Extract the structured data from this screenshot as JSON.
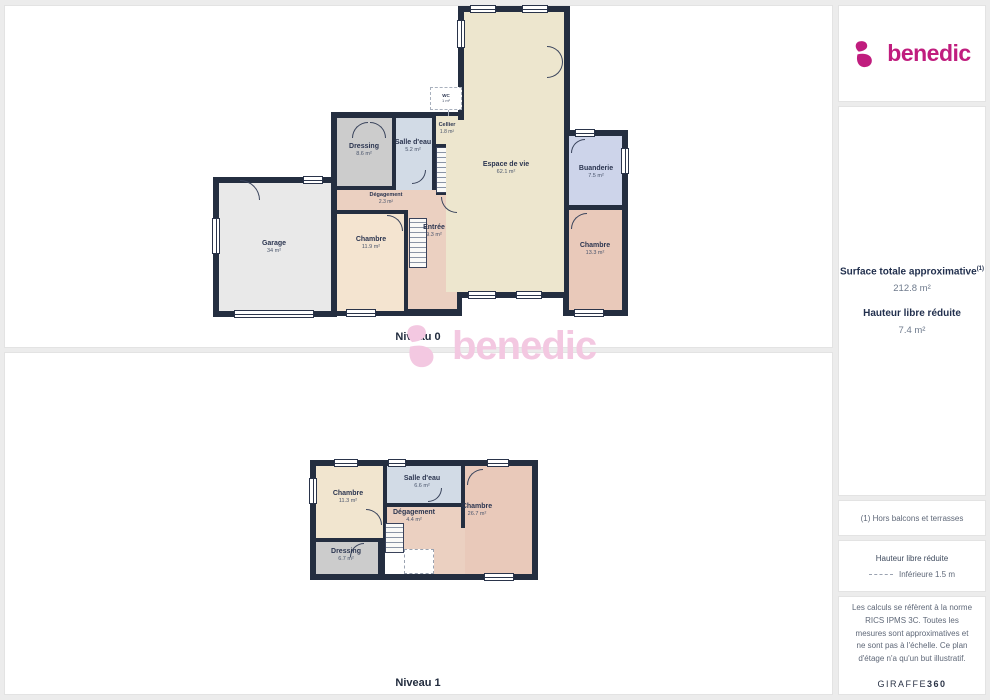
{
  "brand": {
    "name": "benedic",
    "color": "#c01d7e"
  },
  "watermark": "benedic",
  "sidebar": {
    "surface_title": "Surface totale approximative",
    "surface_sup": "(1)",
    "surface_value": "212.8 m²",
    "hauteur_title": "Hauteur libre réduite",
    "hauteur_value": "7.4 m²",
    "note": "(1) Hors balcons et terrasses",
    "legend_title": "Hauteur libre réduite",
    "legend_item": "Inférieure 1.5 m",
    "legal": "Les calculs se réfèrent à la norme RICS IPMS 3C. Toutes les mesures sont approximatives et ne sont pas à l'échelle. Ce plan d'étage n'a qu'un but illustratif.",
    "credit_brand": "GIRAFFE",
    "credit_suffix": "360"
  },
  "level0": {
    "title": "Niveau 0",
    "rooms": {
      "garage": {
        "label": "Garage",
        "area": "34 m²"
      },
      "dressing": {
        "label": "Dressing",
        "area": "8.6 m²"
      },
      "salle_eau": {
        "label": "Salle d'eau",
        "area": "5.2 m²"
      },
      "cellier": {
        "label": "Cellier",
        "area": "1.8 m²"
      },
      "wc": {
        "label": "WC",
        "area": "1 m²"
      },
      "degagement": {
        "label": "Dégagement",
        "area": "2.3 m²"
      },
      "chambre1": {
        "label": "Chambre",
        "area": "11.9 m²"
      },
      "entree": {
        "label": "Entrée",
        "area": "9.3 m²"
      },
      "espace_vie": {
        "label": "Espace de vie",
        "area": "62.1 m²"
      },
      "buanderie": {
        "label": "Buanderie",
        "area": "7.5 m²"
      },
      "chambre2": {
        "label": "Chambre",
        "area": "13.3 m²"
      }
    }
  },
  "level1": {
    "title": "Niveau 1",
    "rooms": {
      "chambre1": {
        "label": "Chambre",
        "area": "11.3 m²"
      },
      "salle_eau": {
        "label": "Salle d'eau",
        "area": "6.6 m²"
      },
      "degagement": {
        "label": "Dégagement",
        "area": "4.4 m²"
      },
      "chambre2": {
        "label": "Chambre",
        "area": "26.7 m²"
      },
      "dressing": {
        "label": "Dressing",
        "area": "6.7 m²"
      }
    }
  }
}
